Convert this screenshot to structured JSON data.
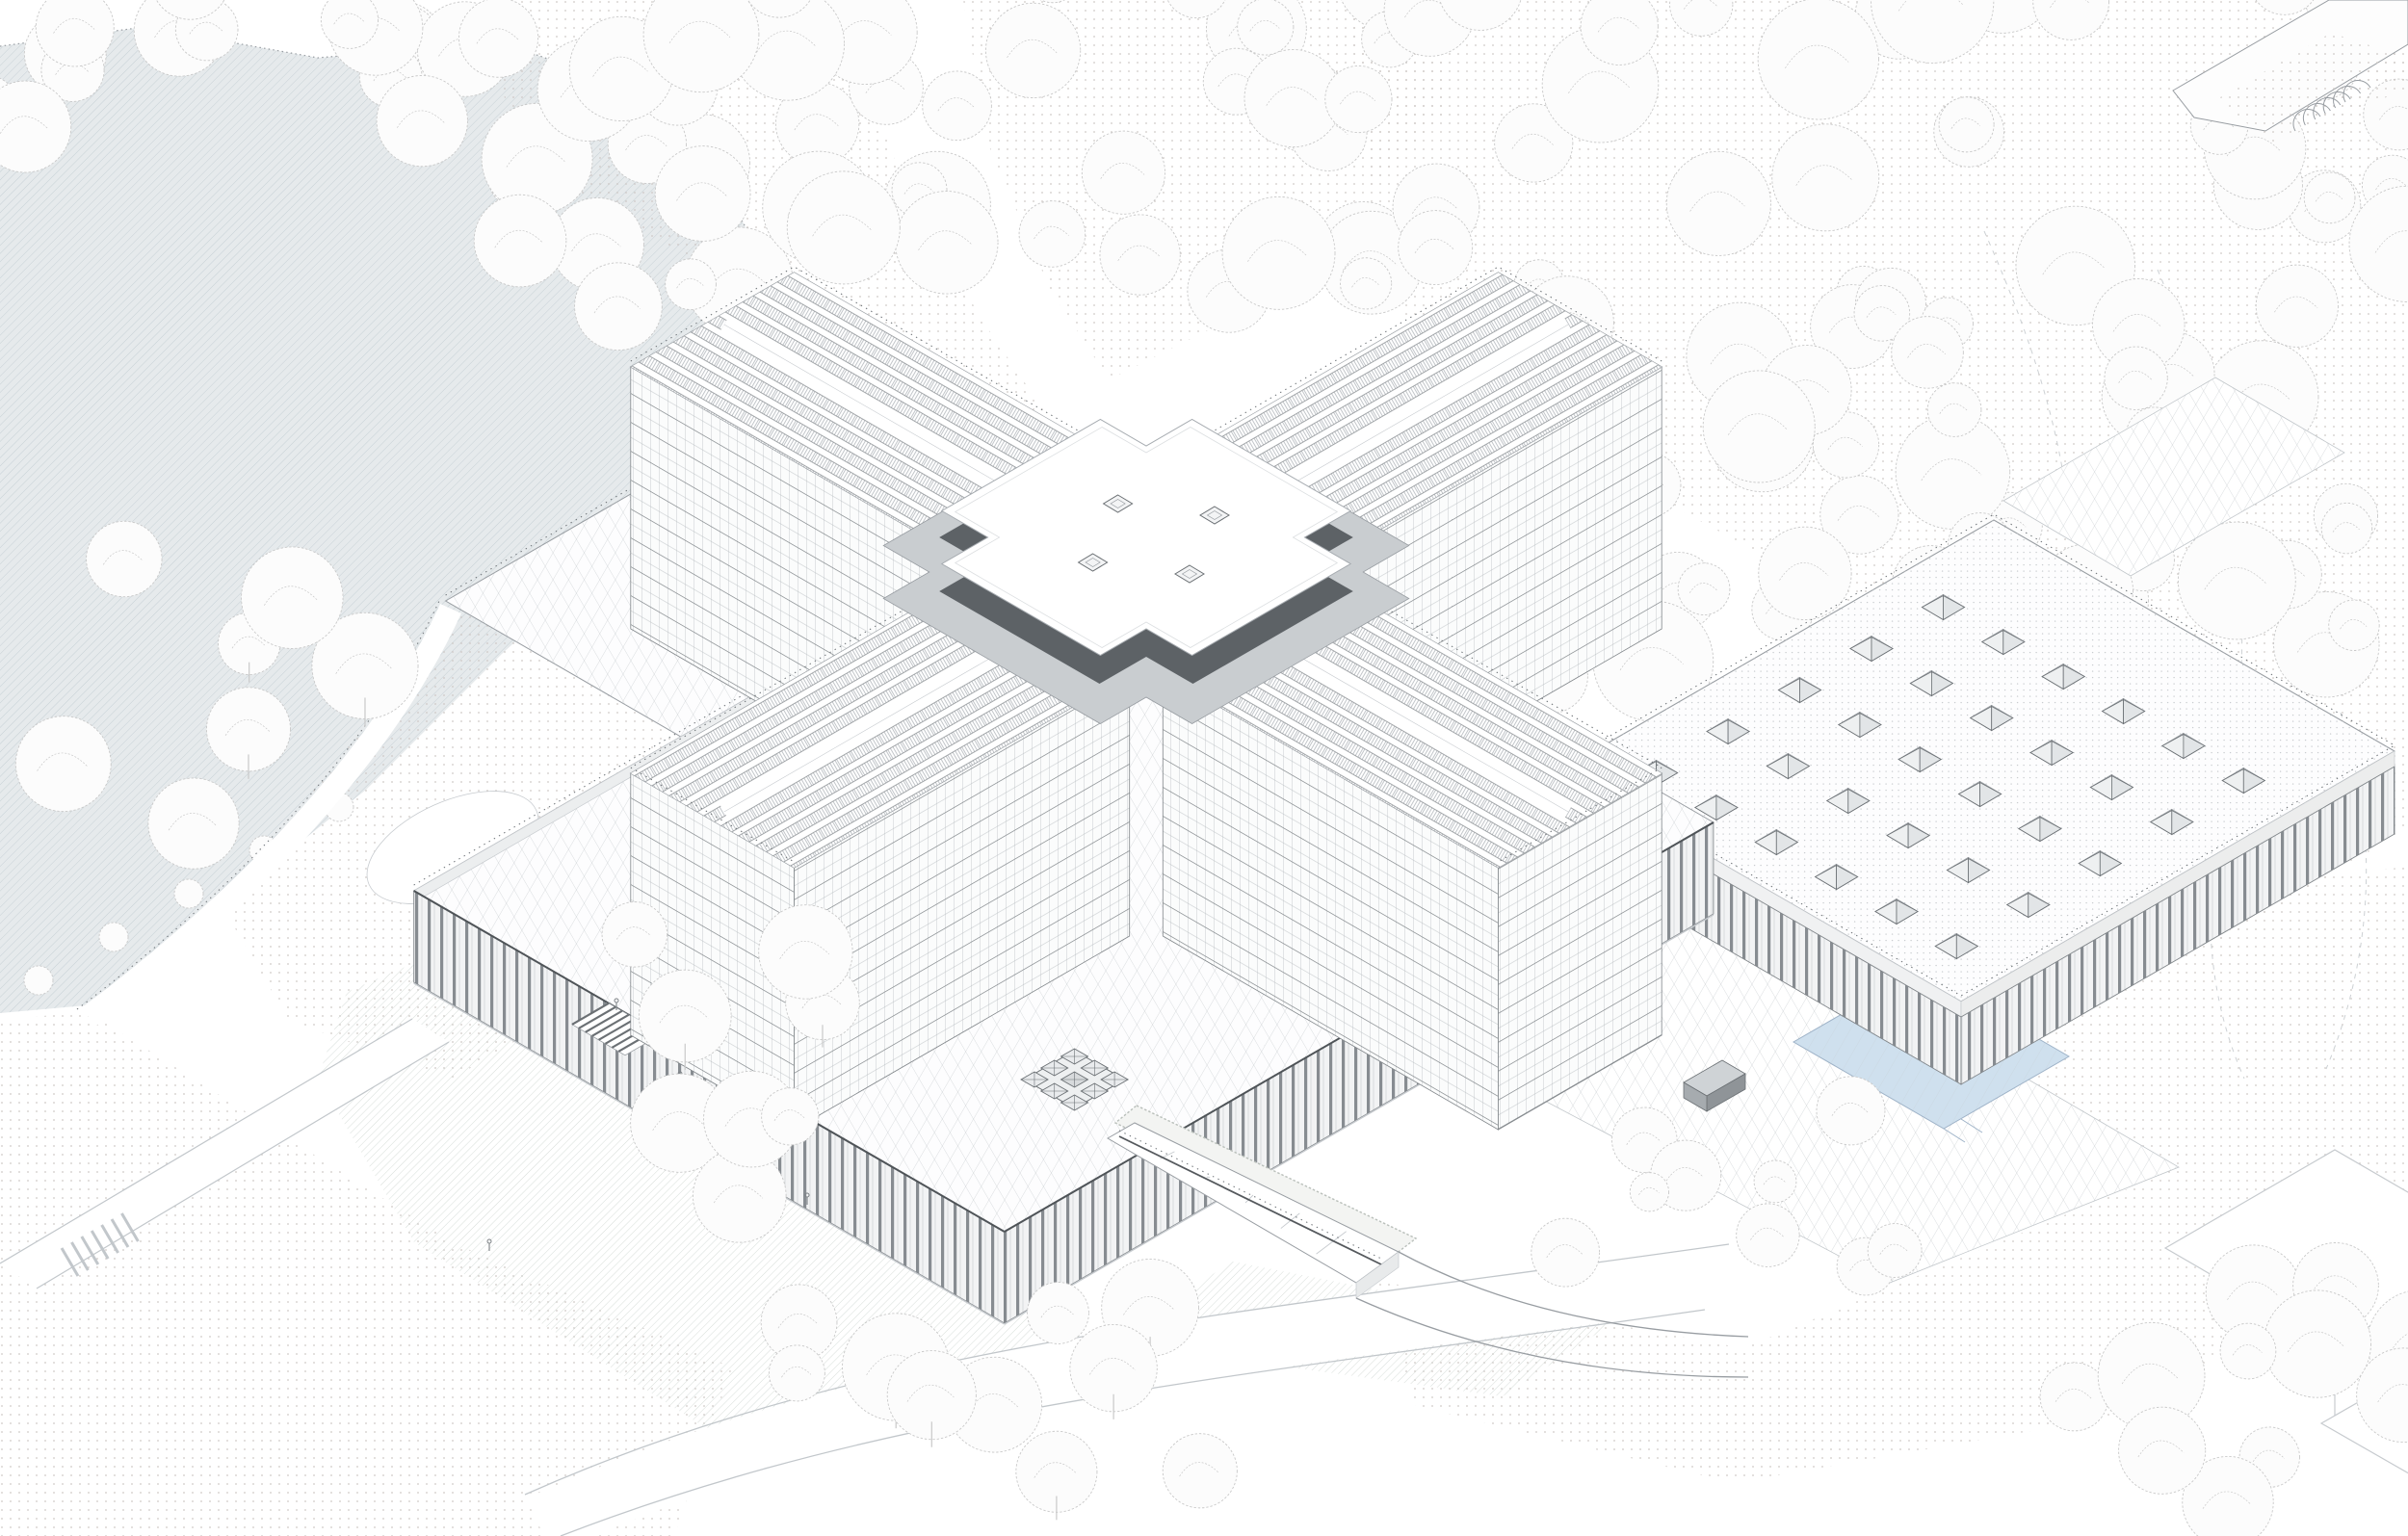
{
  "title": "Axonometric site drawing — cruciform tower on a podium with skylit annex hall, lake and forest",
  "palette": {
    "bg": "#ffffff",
    "line_light": "#c7cbcf",
    "line_mid": "#989da2",
    "line_dark": "#6b7074",
    "slab": "#82878b",
    "mullion": "#b7bcc0",
    "panel": "#a4aaaf",
    "pave": "#c2c7cb",
    "stipple": "#ccc6c3",
    "stipple2": "#c9cdd0",
    "lake_fill": "#e6eaec",
    "lake_hatch": "#c4ced4",
    "lawn_hatch": "#cdd4d0",
    "pool": "#cfe0ee",
    "pool_edge": "#9fb3c8",
    "parapet_dark": "#5d6266",
    "fin_dark": "#878c91",
    "fin_bg": "#f2f3f4",
    "roof_white": "#fdfdfe",
    "face_light": "#eef0f1",
    "face_shade": "#e2e5e7",
    "tree_stroke": "#c9c9c9",
    "tree_fill": "#fcfcfc",
    "hedge": "#b9bfba",
    "figure": "#7d8286",
    "rail": "#74797d",
    "truck": "#8f9498"
  },
  "scene": {
    "tower": {
      "wing_count": 4,
      "visible_floor_count": 9,
      "cross_roof_skylight_count": 4
    },
    "podium": {
      "courtyard_skylight_grid_rows": 3,
      "courtyard_skylight_grid_cols": 3,
      "entry_stair_fin_count": 8
    },
    "annex_hall": {
      "skylight_rows": 5,
      "skylight_cols": 6
    },
    "landscape": {
      "figure_count": 4,
      "house_count": 2,
      "contour_line_count": 3,
      "crosswalk_stripe_count": 7,
      "greenhouse_rib_count": 6,
      "road_tree_count": 5
    }
  }
}
